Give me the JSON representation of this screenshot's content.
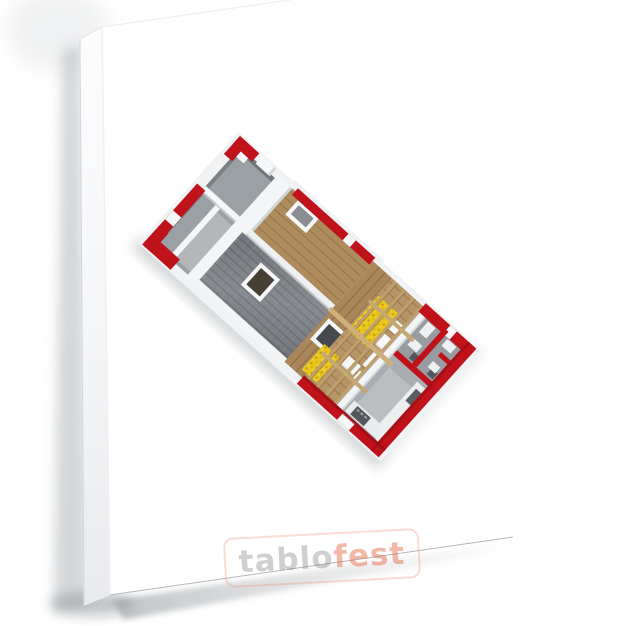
{
  "watermark": {
    "prefix": "tablo",
    "suffix": "fest"
  },
  "artwork": {
    "type": "3d-house-cutaway-floor-plan-render",
    "parts": [
      "red-perimeter-walls",
      "bedroom-rooms",
      "gable-wall",
      "tiled-roof-slope",
      "roof-ridge",
      "wood-sheathing",
      "skylight-windows",
      "roof-hatch",
      "wood-decking",
      "attic-floor",
      "mineral-wool-insulation",
      "drywall-panels",
      "rafters",
      "bathroom-rooms",
      "kitchen",
      "kitchen-counters",
      "oven-appliance"
    ]
  },
  "colors": {
    "wall_red": "#c0121a",
    "wall_red_dark": "#8d0e13",
    "roof_tile_gray": "#71757a",
    "wood": "#ae8b5c",
    "wood_deck": "#a9875a",
    "wood_light": "#bfa06d",
    "insulation_yellow": "#e9c71e",
    "floor_gray": "#9ba0a4",
    "canvas_white": "#ffffff",
    "shadow_gray": "#9aa0a5",
    "watermark_gray": "#6e6e71",
    "watermark_orange": "#e2582f"
  }
}
